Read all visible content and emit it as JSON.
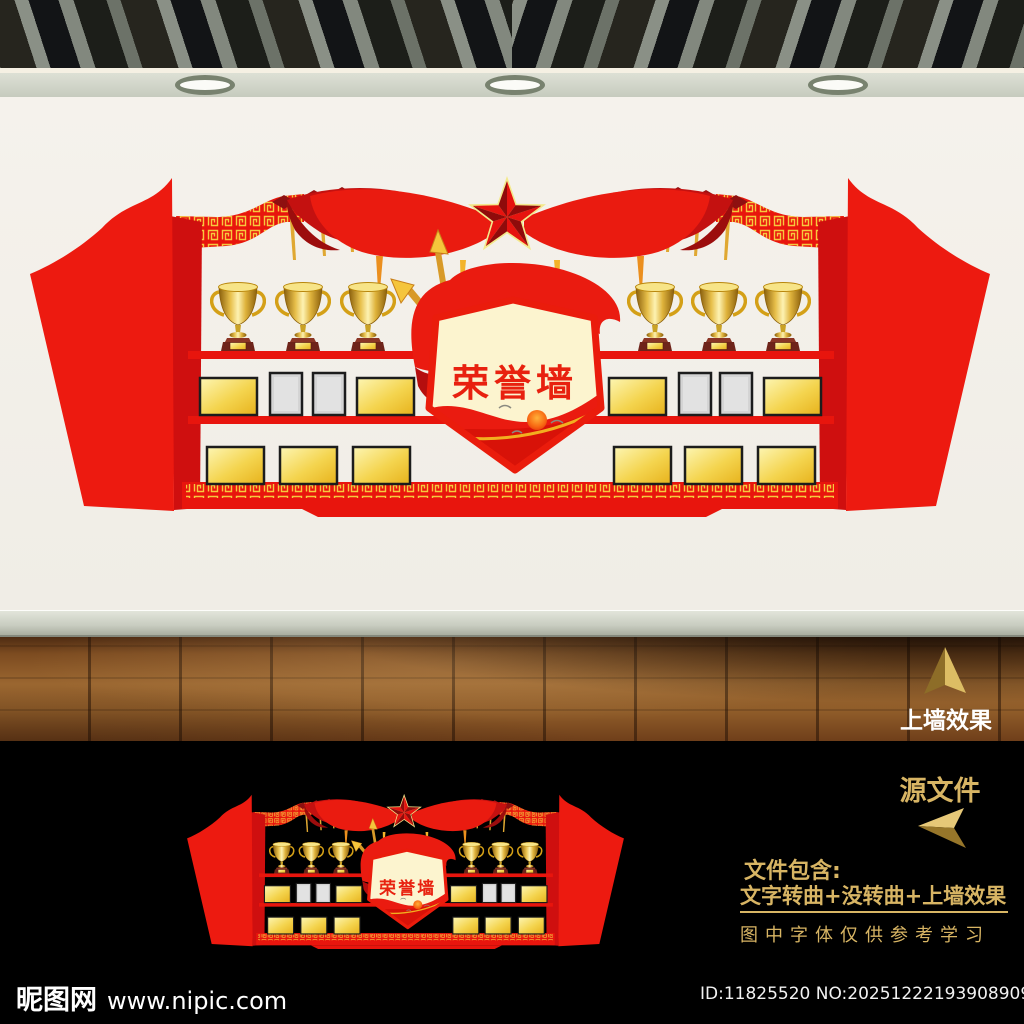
{
  "design": {
    "badge_title": "荣誉墙",
    "left_trophies": 3,
    "right_trophies": 3,
    "middle_row_plaques_per_side": [
      "gold",
      "gray",
      "gray",
      "gold"
    ],
    "bottom_row_plaques_per_side": [
      "gold",
      "gold",
      "gold"
    ],
    "colors": {
      "primary_red": "#e8150d",
      "dark_red": "#b50e0e",
      "gold_trim": "#f6c93e",
      "badge_cream": "#fcf4cf",
      "badge_text_red": "#e8210f"
    }
  },
  "mockup": {
    "floor_label": "上墙效果"
  },
  "info_panel": {
    "source_file_label": "源文件",
    "includes_heading": "文件包含:",
    "includes_content": "文字转曲+没转曲+上墙效果",
    "font_note": "图中字体仅供参考学习",
    "text_gold": "#d8b564"
  },
  "footer": {
    "site_name": "昵图网",
    "site_url": "www.nipic.com",
    "image_id": "ID:11825520 NO:20251222193908909100"
  }
}
